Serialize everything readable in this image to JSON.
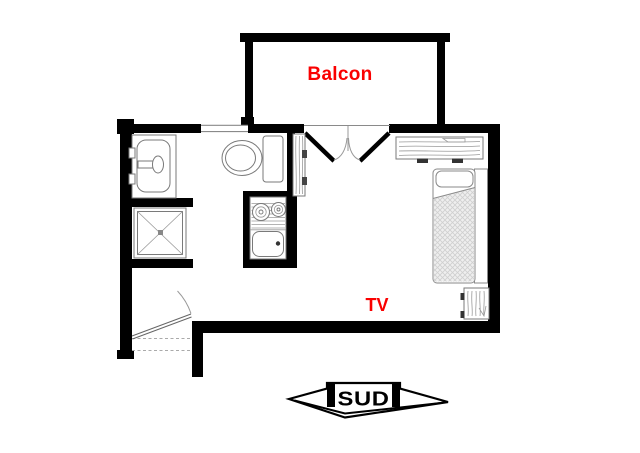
{
  "plan": {
    "labels": {
      "balcony": "Balcon",
      "tv": "TV",
      "south": "SUD"
    },
    "colors": {
      "wall": "#000000",
      "label": "#fa0000",
      "outline": "#7a7a7a",
      "background": "#ffffff"
    }
  }
}
